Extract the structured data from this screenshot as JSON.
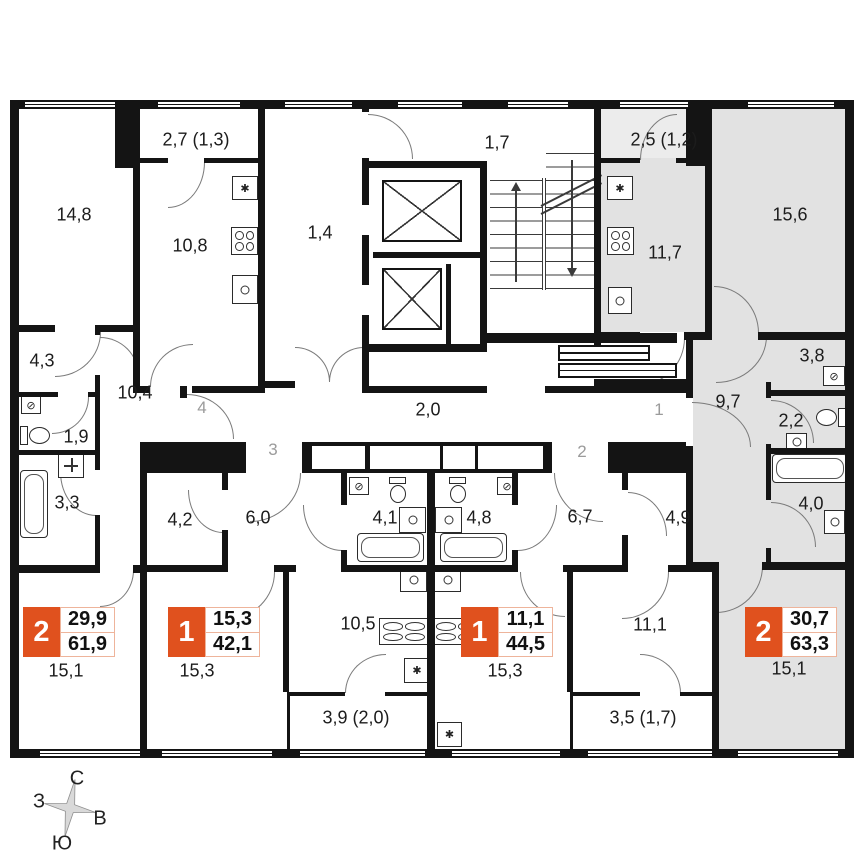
{
  "colors": {
    "wall": "#141414",
    "highlight": "#e2e2e2",
    "badge_red": "#e0511e",
    "door_arc": "#7a7a7a"
  },
  "icons": {
    "vent": "✱",
    "washer": "⊘"
  },
  "common_areas": {
    "elevator_lobby": "1,4",
    "stair_corridor": "1,7",
    "corridor": "2,0"
  },
  "apartments": {
    "apt4": {
      "entry_number": "4",
      "badge": {
        "rooms": "2",
        "living_area": "29,9",
        "total_area": "61,9"
      },
      "rooms": {
        "bedroom": "14,8",
        "balcony": "2,7 (1,3)",
        "kitchen": "10,8",
        "wardrobe": "4,3",
        "hallway": "10,4",
        "wc": "1,9",
        "bathroom": "3,3",
        "living_room": "15,1"
      }
    },
    "apt3": {
      "entry_number": "3",
      "badge": {
        "rooms": "1",
        "living_area": "15,3",
        "total_area": "42,1"
      },
      "rooms": {
        "wardrobe": "4,2",
        "hallway": "6,0",
        "bathroom": "4,1",
        "kitchen": "10,5",
        "living_room": "15,3",
        "balcony": "3,9 (2,0)"
      }
    },
    "apt2": {
      "entry_number": "2",
      "badge": {
        "rooms": "1",
        "living_area": "11,1",
        "total_area": "44,5"
      },
      "rooms": {
        "bathroom": "4,8",
        "hallway": "6,7",
        "wardrobe": "4,9",
        "living_room": "15,3",
        "bedroom": "11,1",
        "balcony": "3,5 (1,7)"
      }
    },
    "apt1": {
      "entry_number": "1",
      "badge": {
        "rooms": "2",
        "living_area": "30,7",
        "total_area": "63,3"
      },
      "rooms": {
        "balcony": "2,5 (1,2)",
        "kitchen": "11,7",
        "bedroom": "15,6",
        "wardrobe": "3,8",
        "hallway": "9,7",
        "wc": "2,2",
        "bathroom": "4,0",
        "living_room": "15,1"
      }
    }
  },
  "compass": {
    "north": "С",
    "south": "Ю",
    "west": "З",
    "east": "В"
  }
}
